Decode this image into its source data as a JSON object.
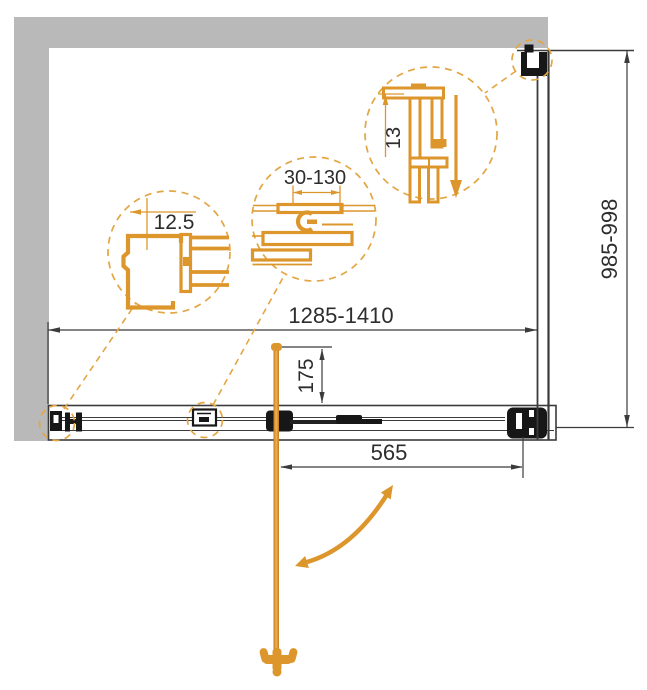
{
  "drawing": {
    "title": "Shower enclosure dimensional plan drawing",
    "labels": {
      "width_range": "1285-1410",
      "depth_range": "985-998",
      "handle_distance": "565",
      "handle_offset": "175",
      "detail_wall_profile": "12.5",
      "detail_adjustment_range": "30-130",
      "detail_glass_gap": "13"
    },
    "colors": {
      "accent_orange": "#DD962C",
      "dashed_orange": "#E3A644",
      "wall_gray": "#B9B9B9",
      "line_dark": "#3B3B3B",
      "hardware_black": "#171717"
    }
  }
}
